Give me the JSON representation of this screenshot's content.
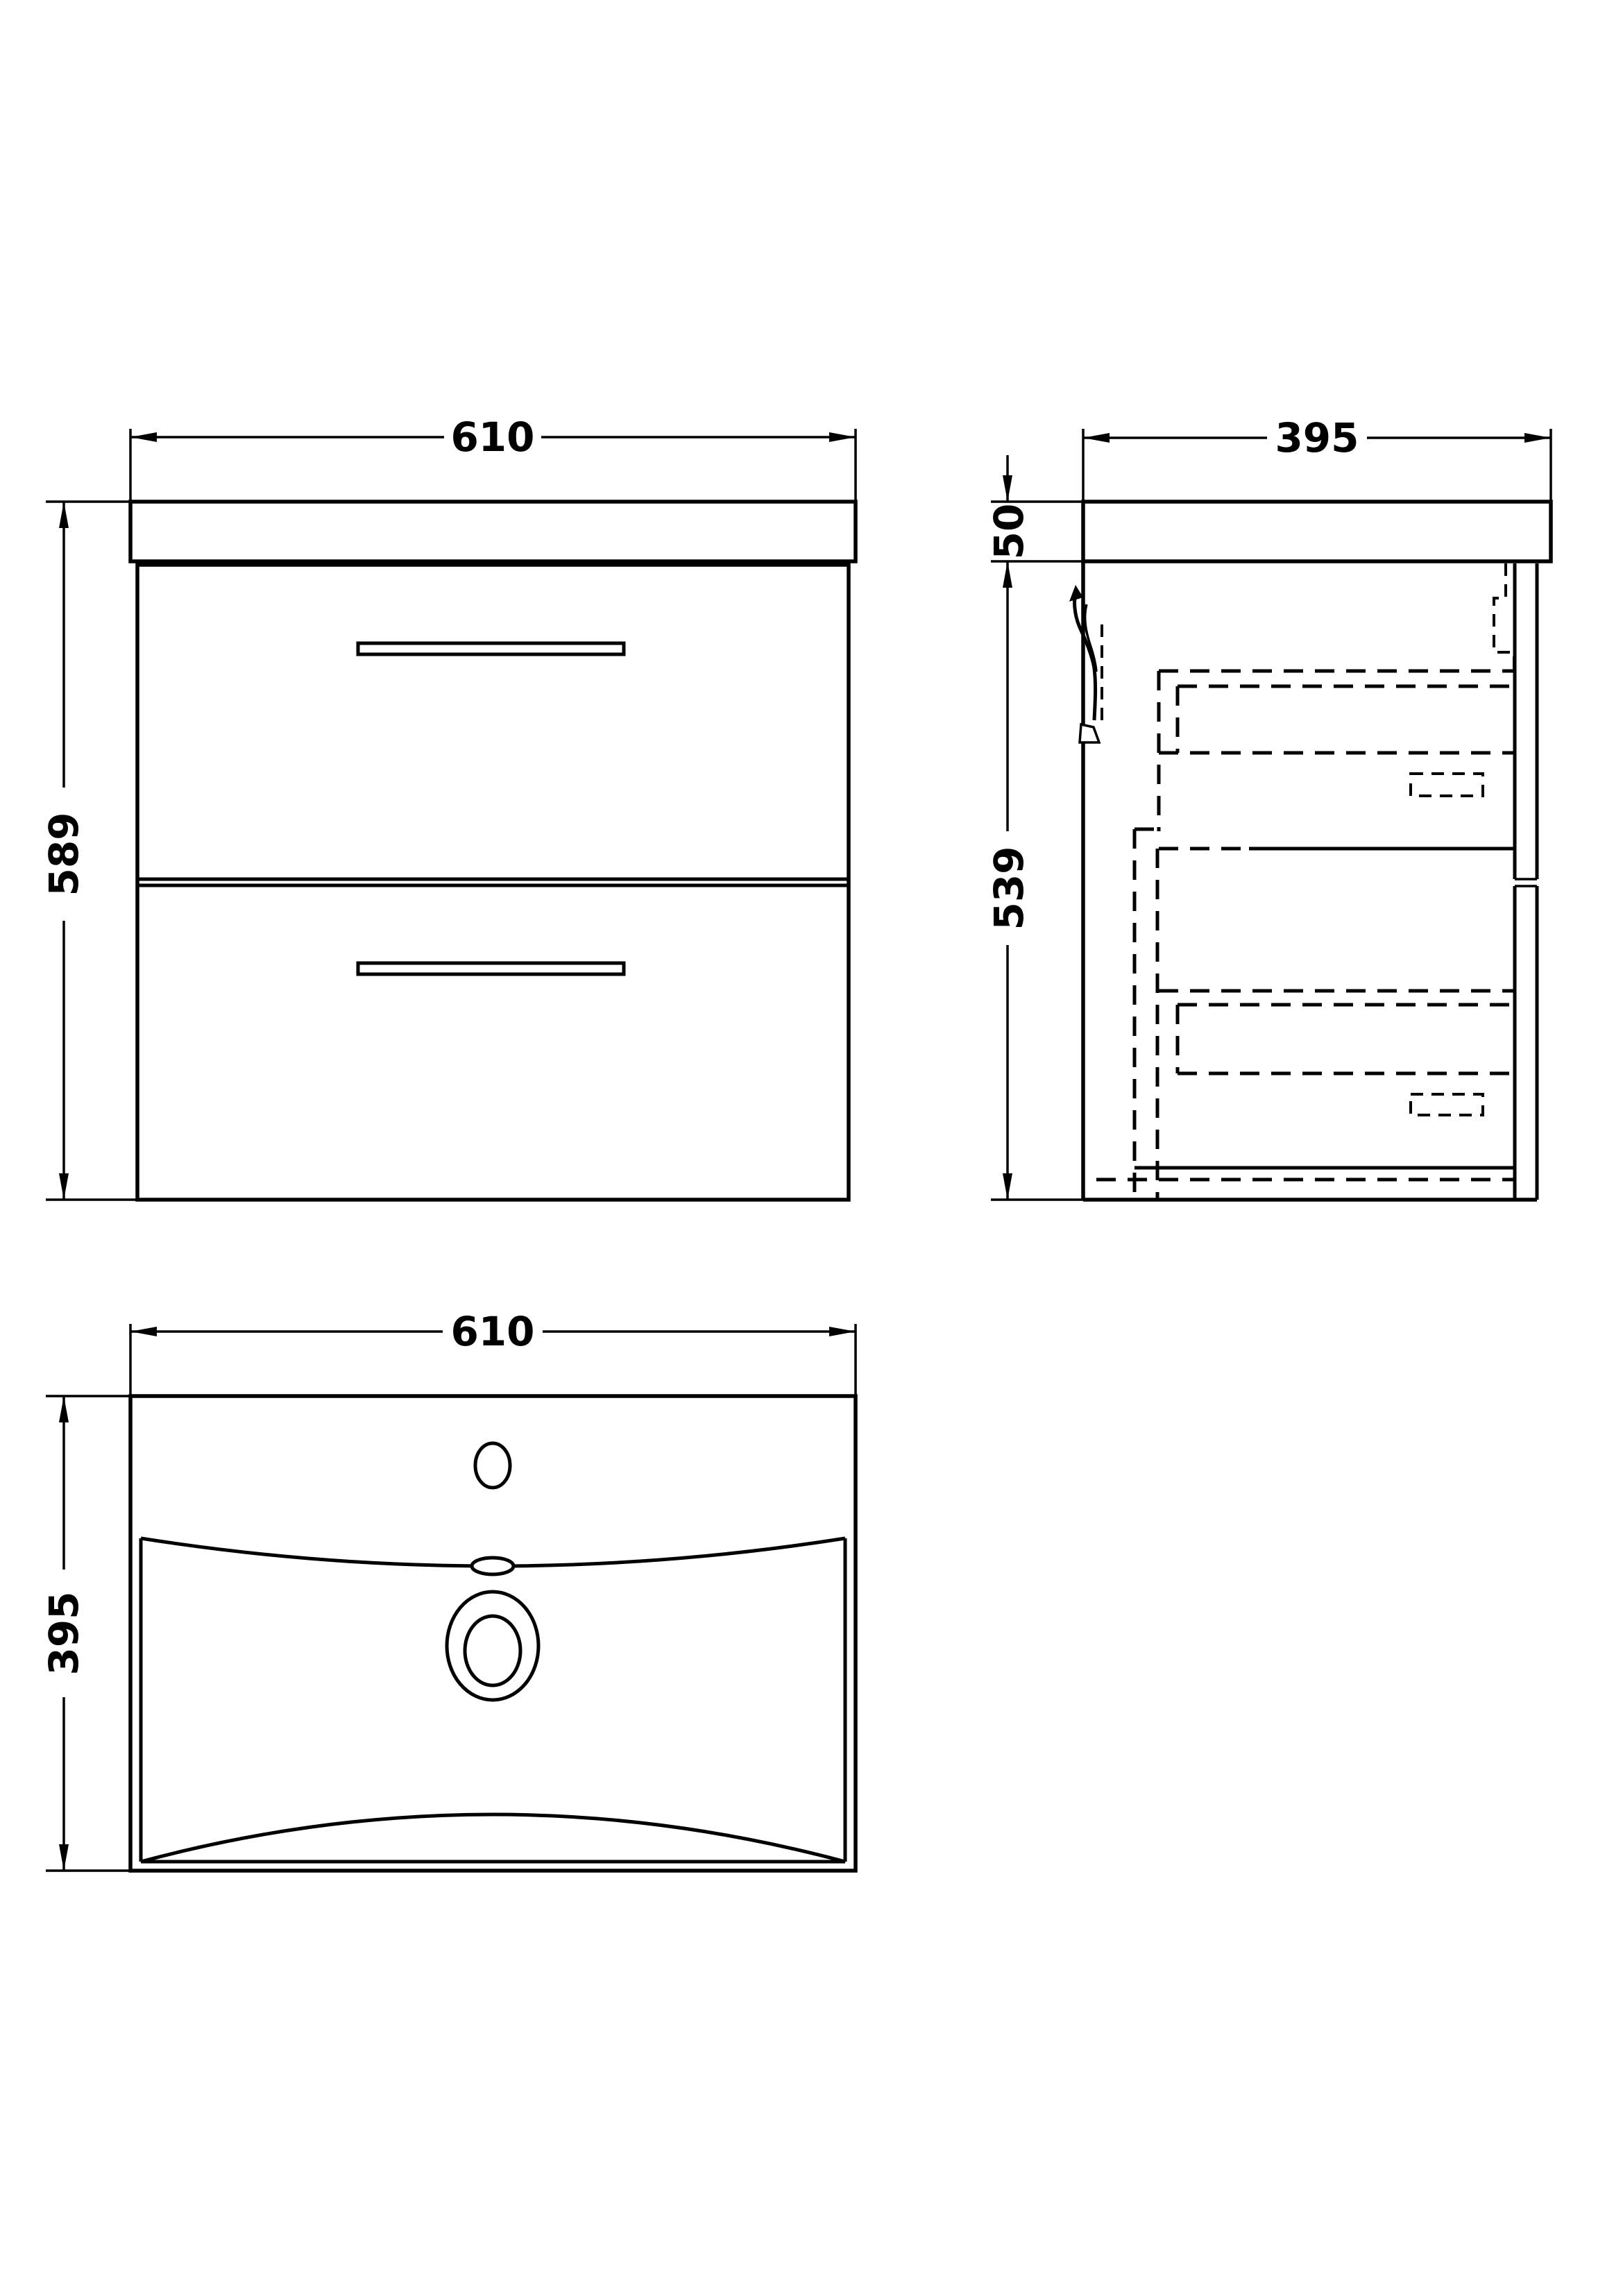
{
  "page": {
    "background_color": "#ffffff",
    "line_color": "#000000"
  },
  "views": {
    "front": {
      "width_label": "610",
      "height_label": "589"
    },
    "side": {
      "depth_label": "395",
      "worktop_height_label": "50",
      "cabinet_height_label": "539"
    },
    "plan": {
      "width_label": "610",
      "depth_label": "395"
    }
  }
}
